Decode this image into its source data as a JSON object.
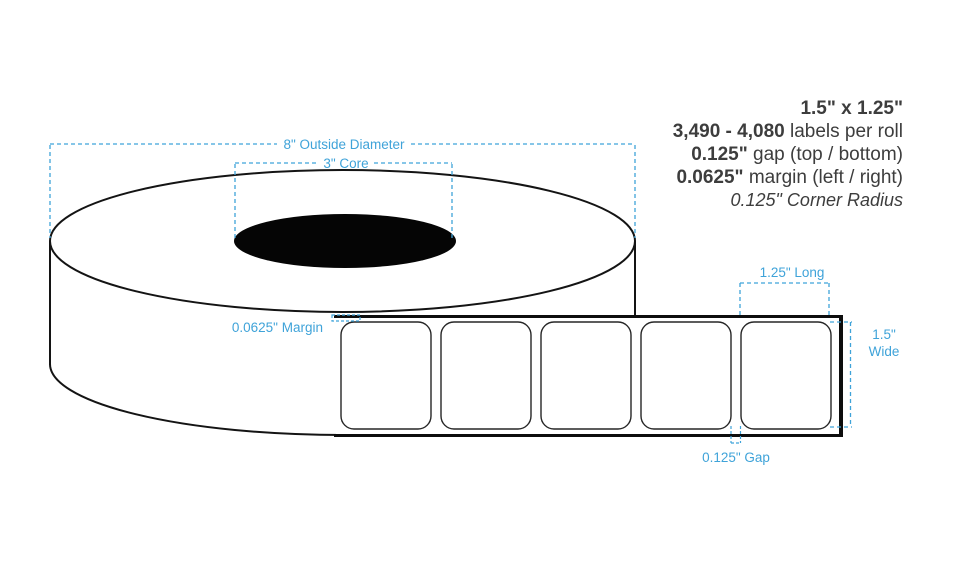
{
  "title": "Label roll specification diagram",
  "specs": {
    "size": "1.5\" x 1.25\"",
    "labels_per_roll_value": "3,490 - 4,080",
    "labels_per_roll_text": " labels per roll",
    "gap_value": "0.125\"",
    "gap_text": " gap (top / bottom)",
    "margin_value": "0.0625\"",
    "margin_text": " margin (left / right)",
    "corner_radius": "0.125\" Corner Radius"
  },
  "annotations": {
    "outside_diameter": "8\" Outside Diameter",
    "core": "3\" Core",
    "margin": "0.0625\" Margin",
    "label_length": "1.25\" Long",
    "label_width_line1": "1.5\"",
    "label_width_line2": "Wide",
    "gap": "0.125\" Gap"
  },
  "diagram": {
    "label_count": 5,
    "label_shape": "rounded-rectangle"
  },
  "colors": {
    "annotation_blue": "#3fa3d9",
    "text_dark": "#3d3d3d",
    "outline_black": "#141414"
  }
}
